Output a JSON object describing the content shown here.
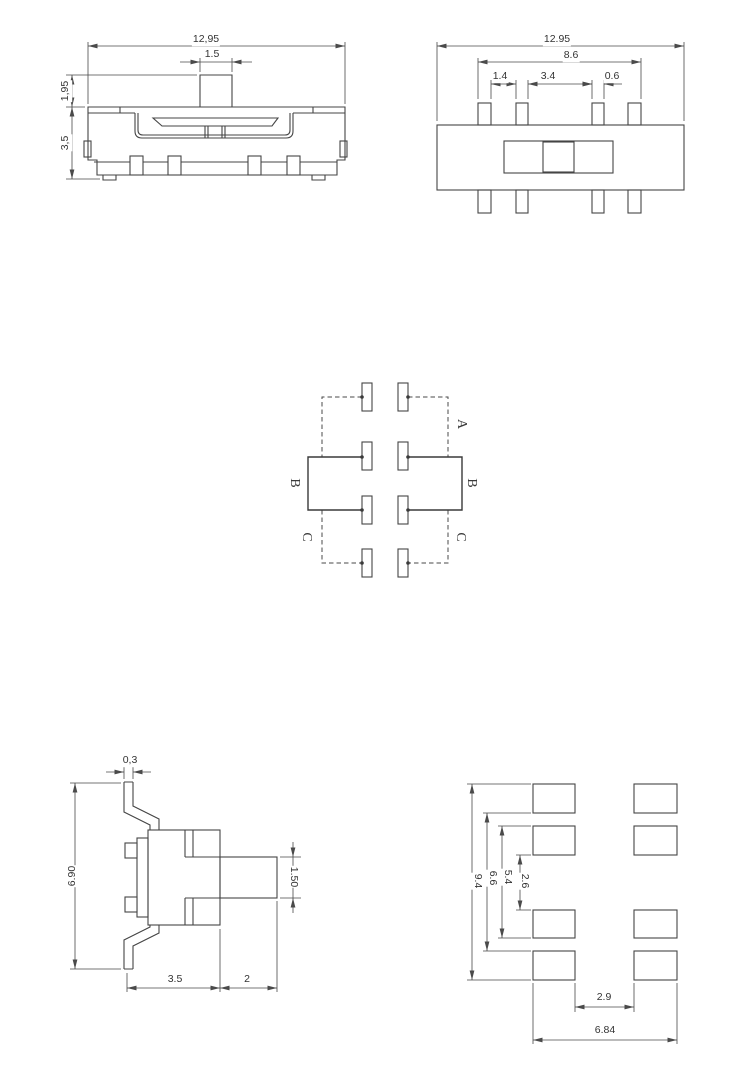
{
  "front_view": {
    "total_width": "12,95",
    "stem_width": "1.5",
    "stem_height": "1,95",
    "body_height": "3,5"
  },
  "top_view": {
    "total_width": "12.95",
    "pin_row_span": "8.6",
    "pin_gap_outer": "1.4",
    "pin_gap_center": "3.4",
    "pin_width": "0.6"
  },
  "schematic": {
    "pole_a_right": "A",
    "pole_b_left": "B",
    "pole_b_right": "B",
    "pole_c_left": "C",
    "pole_c_right": "C"
  },
  "side_view": {
    "bracket_thickness": "0,3",
    "overall_height": "6.90",
    "stem_height": "1.50",
    "body_depth": "3.5",
    "stem_length": "2"
  },
  "land_pattern": {
    "overall_height": "9.4",
    "span_66": "6.6",
    "span_54": "5.4",
    "pad_gap_vertical": "2.6",
    "pad_gap_horizontal": "2.9",
    "overall_width": "6.84"
  },
  "colors": {
    "line": "#454545",
    "text": "#333333",
    "background": "#ffffff"
  }
}
